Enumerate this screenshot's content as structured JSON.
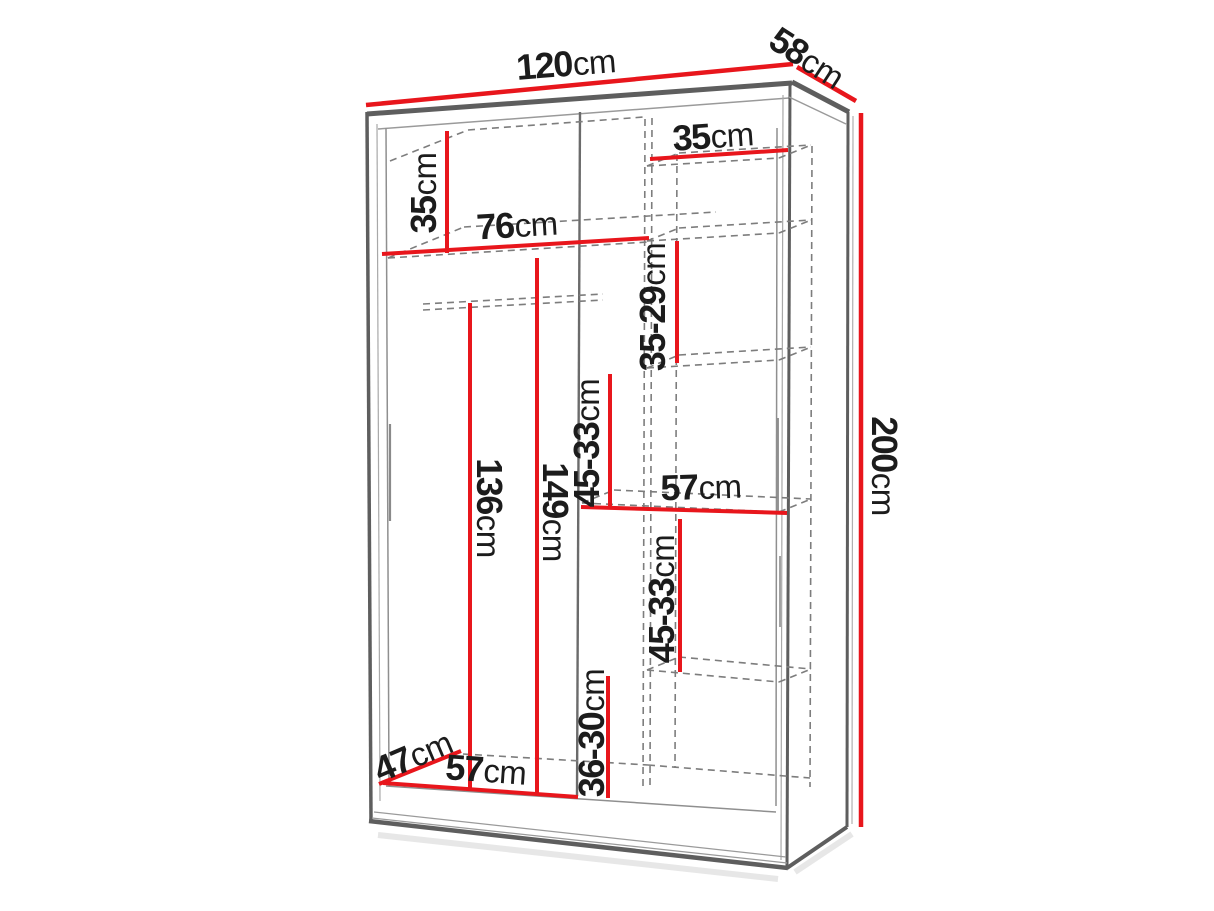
{
  "diagram": {
    "kind": "wardrobe-dimension-diagram",
    "unit": "cm",
    "dims": {
      "d120": {
        "value": "120",
        "unit": "cm"
      },
      "d58": {
        "value": "58",
        "unit": "cm"
      },
      "d200": {
        "value": "200",
        "unit": "cm"
      },
      "d35_left": {
        "value": "35",
        "unit": "cm"
      },
      "d76": {
        "value": "76",
        "unit": "cm"
      },
      "d35_right": {
        "value": "35",
        "unit": "cm"
      },
      "d35_29": {
        "value": "35-29",
        "unit": "cm"
      },
      "d45_33_upper": {
        "value": "45-33",
        "unit": "cm"
      },
      "d57_mid": {
        "value": "57",
        "unit": "cm"
      },
      "d45_33_lower": {
        "value": "45-33",
        "unit": "cm"
      },
      "d36_30": {
        "value": "36-30",
        "unit": "cm"
      },
      "d136": {
        "value": "136",
        "unit": "cm"
      },
      "d149": {
        "value": "149",
        "unit": "cm"
      },
      "d47": {
        "value": "47",
        "unit": "cm"
      },
      "d57_bottom": {
        "value": "57",
        "unit": "cm"
      }
    },
    "colors": {
      "dimension_red": "#e8161c",
      "structure_gray": "#5e5e5e",
      "dashed_gray": "#7d7d7d",
      "text": "#1c1c1c",
      "background": "#ffffff"
    }
  }
}
